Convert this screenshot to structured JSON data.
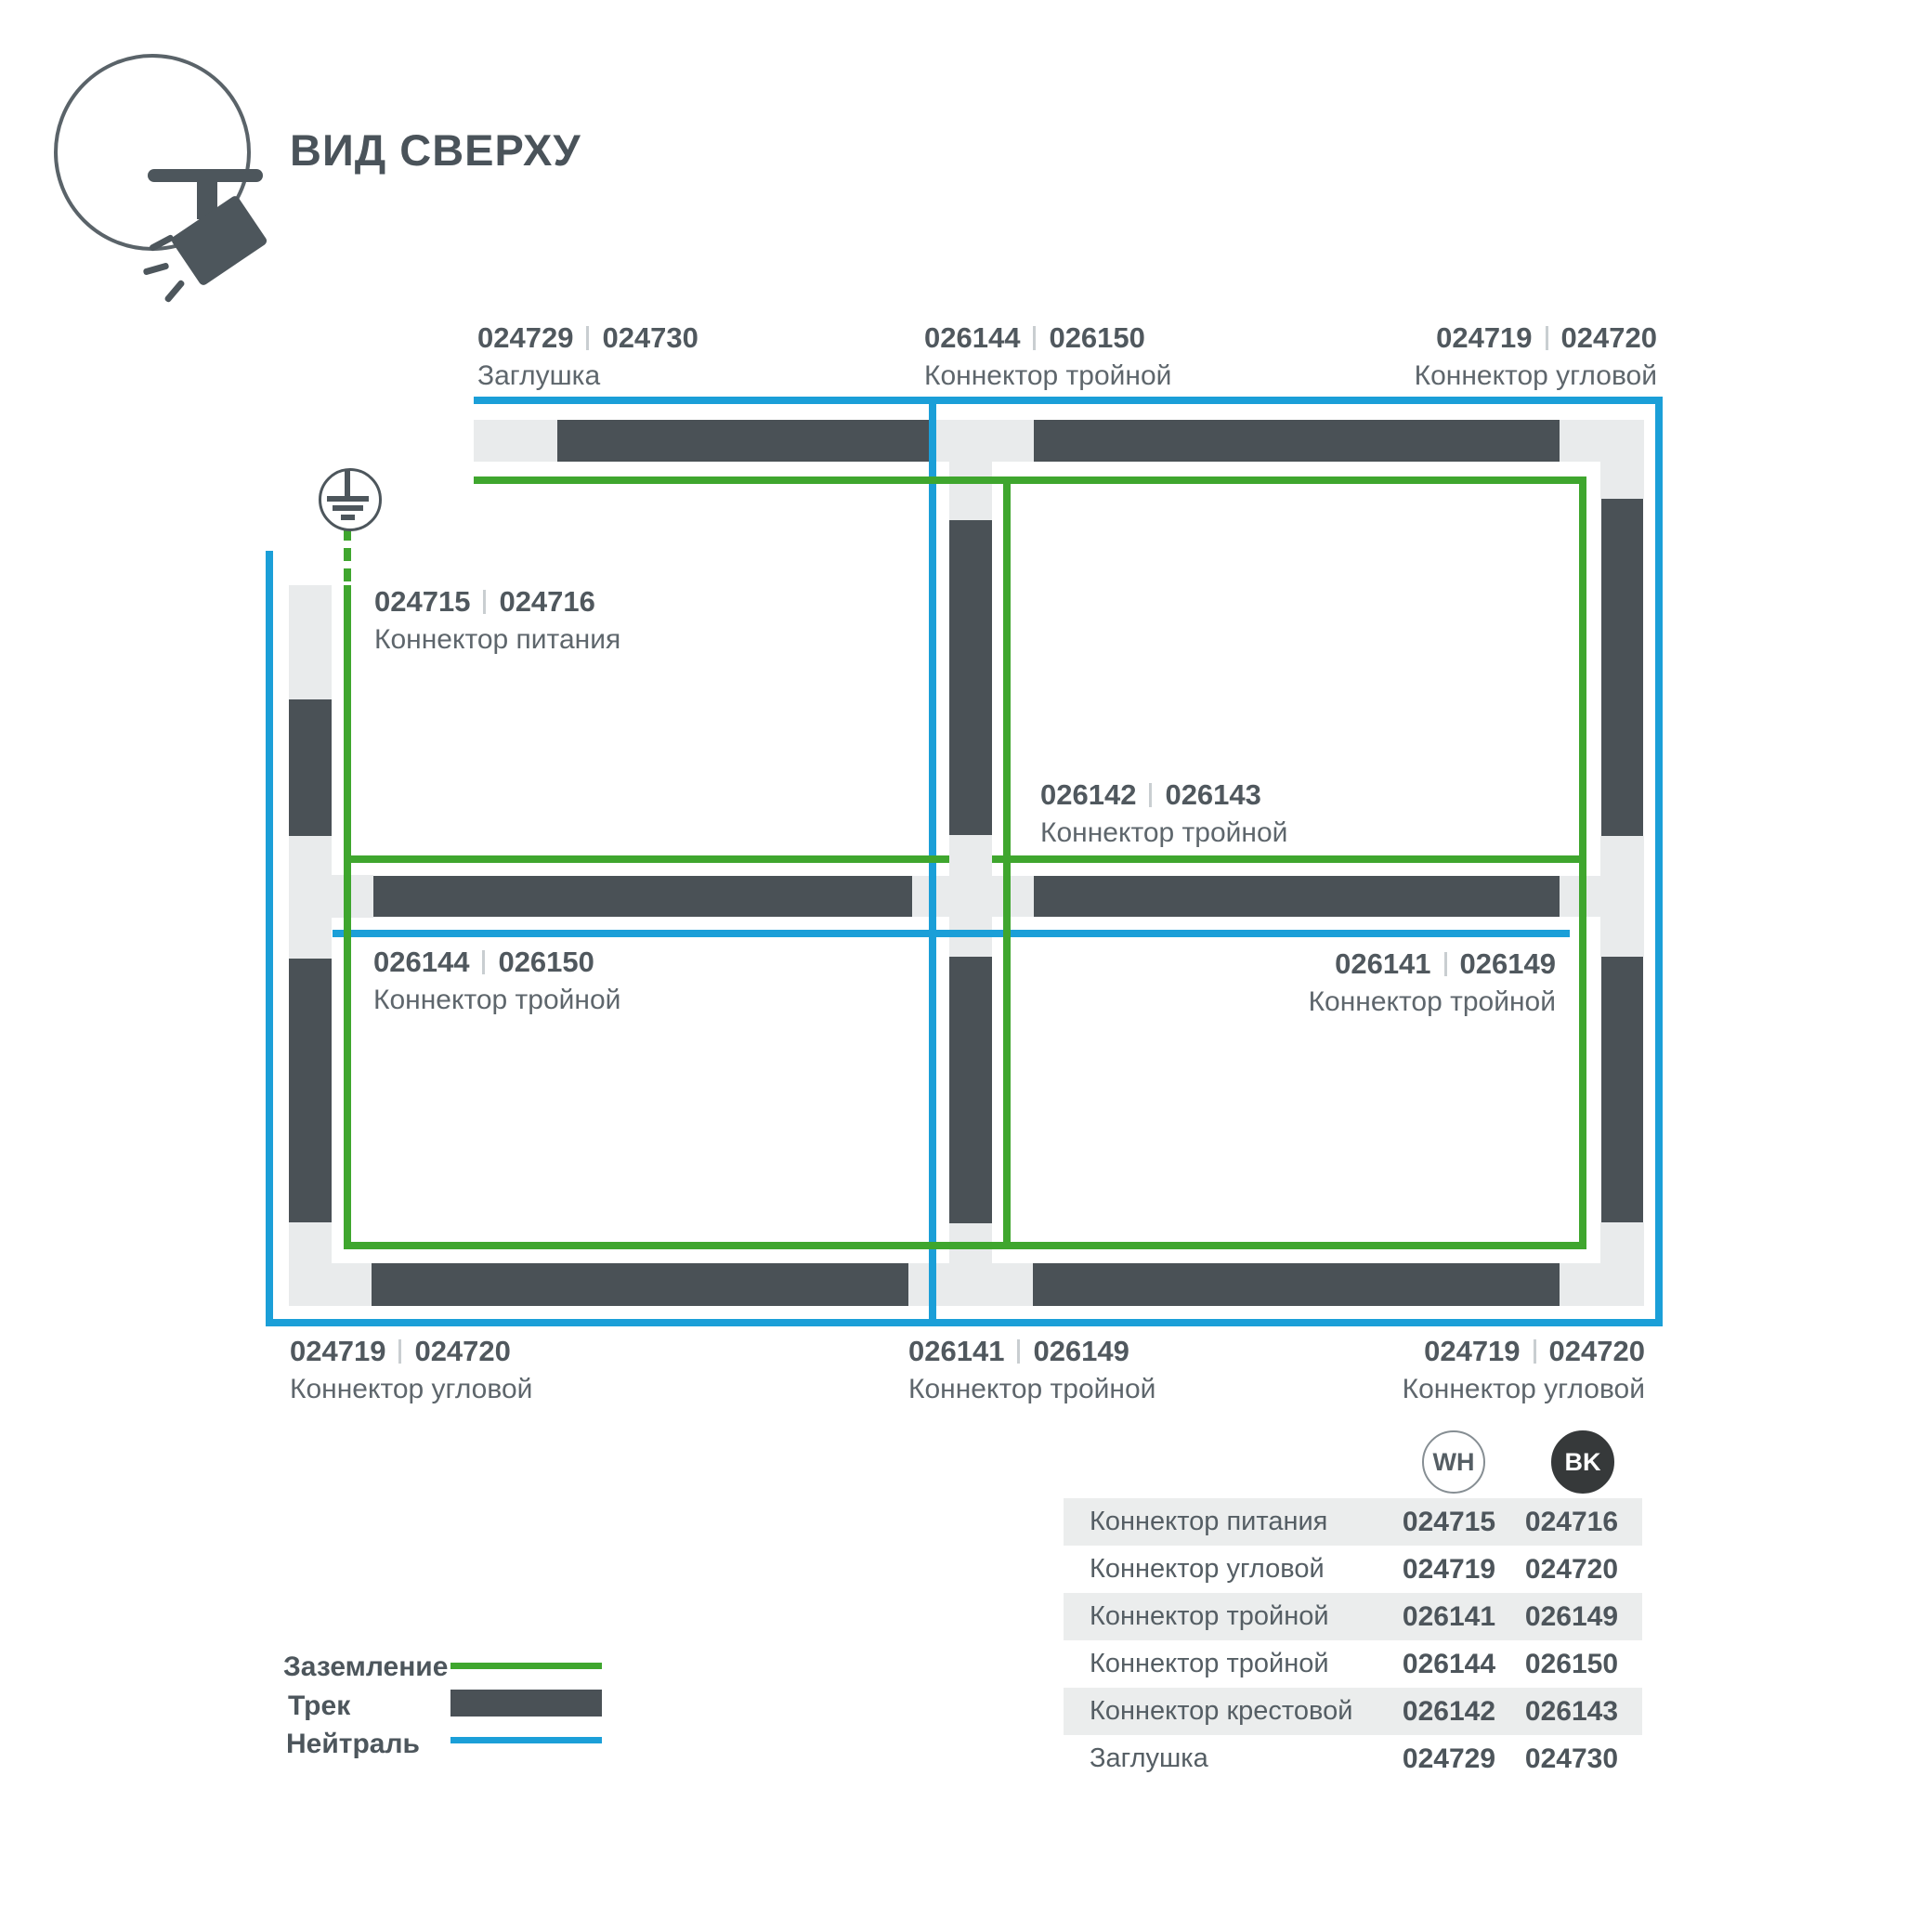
{
  "header": {
    "title": "ВИД СВЕРХУ"
  },
  "colors": {
    "track": "#4A5156",
    "connector_block": "#E9EBEC",
    "ground_green": "#3FA62E",
    "neutral_blue": "#1B9FD8",
    "text_dark": "#4A535A",
    "table_row_bg": "#EBEDED",
    "bk_circle": "#36393A"
  },
  "labels": [
    {
      "code1": "024729",
      "code2": "024730",
      "caption": "Заглушка"
    },
    {
      "code1": "026144",
      "code2": "026150",
      "caption": "Коннектор тройной"
    },
    {
      "code1": "024719",
      "code2": "024720",
      "caption": "Коннектор угловой"
    },
    {
      "code1": "024715",
      "code2": "024716",
      "caption": "Коннектор питания"
    },
    {
      "code1": "026142",
      "code2": "026143",
      "caption": "Коннектор тройной"
    },
    {
      "code1": "026144",
      "code2": "026150",
      "caption": "Коннектор тройной"
    },
    {
      "code1": "026141",
      "code2": "026149",
      "caption": "Коннектор тройной"
    },
    {
      "code1": "024719",
      "code2": "024720",
      "caption": "Коннектор угловой"
    },
    {
      "code1": "026141",
      "code2": "026149",
      "caption": "Коннектор тройной"
    },
    {
      "code1": "024719",
      "code2": "024720",
      "caption": "Коннектор угловой"
    }
  ],
  "legend": [
    {
      "label": "Заземление"
    },
    {
      "label": "Трек"
    },
    {
      "label": "Нейтраль"
    }
  ],
  "table": {
    "col1_header": "WH",
    "col2_header": "BK",
    "rows": [
      {
        "name": "Коннектор питания",
        "wh": "024715",
        "bk": "024716"
      },
      {
        "name": "Коннектор угловой",
        "wh": "024719",
        "bk": "024720"
      },
      {
        "name": "Коннектор тройной",
        "wh": "026141",
        "bk": "026149"
      },
      {
        "name": "Коннектор тройной",
        "wh": "026144",
        "bk": "026150"
      },
      {
        "name": "Коннектор крестовой",
        "wh": "026142",
        "bk": "026143"
      },
      {
        "name": "Заглушка",
        "wh": "024729",
        "bk": "024730"
      }
    ]
  }
}
